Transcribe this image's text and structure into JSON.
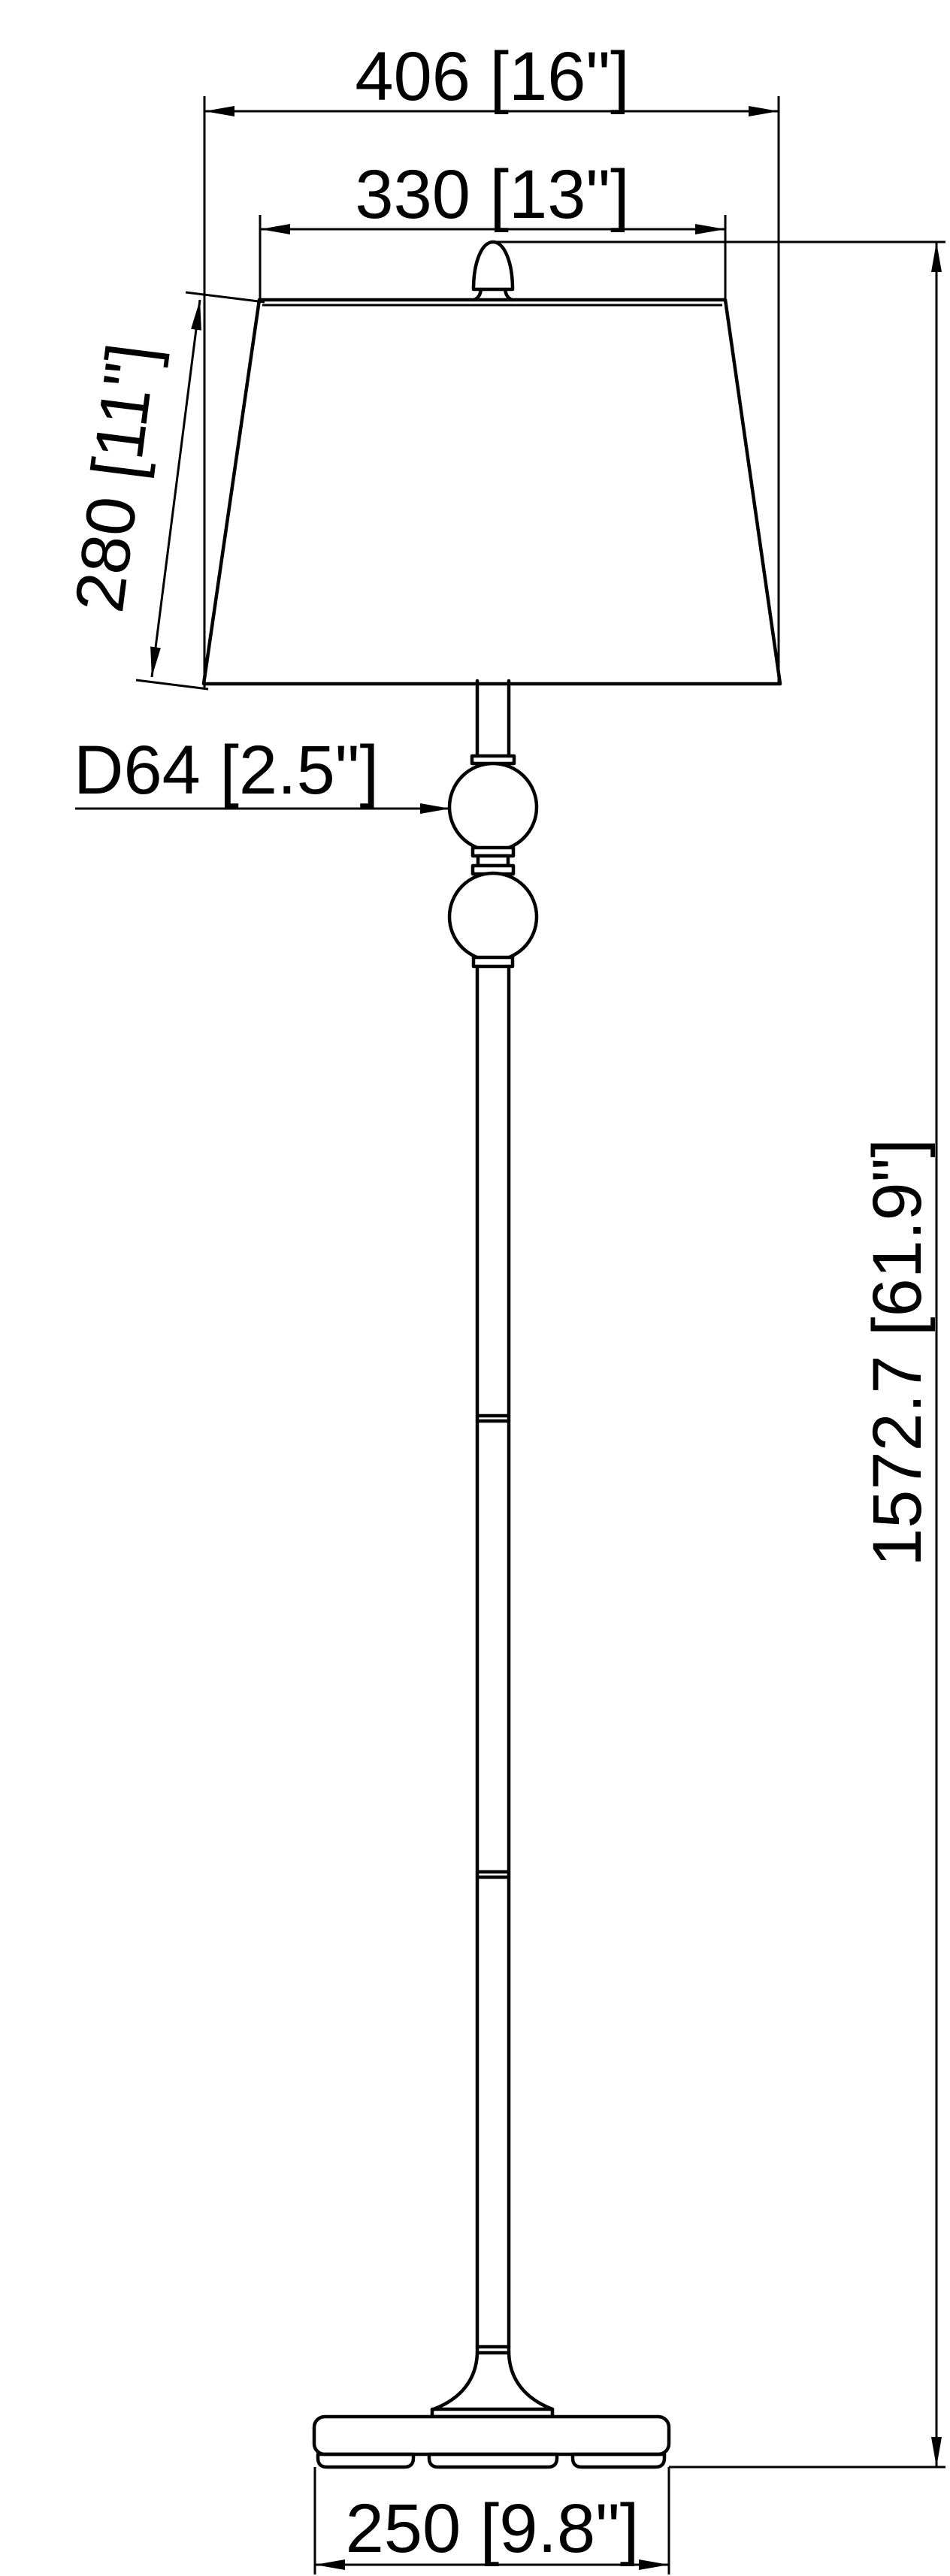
{
  "document": {
    "kind": "technical dimension drawing",
    "subject": "floor lamp with tapered shade, twin glass balls, slim column and oval base",
    "background_color": "#ffffff",
    "line_color": "#000000"
  },
  "dimensions": {
    "shade_bottom_width": {
      "label": "406 [16\"]",
      "value_mm": 406,
      "value_in": "16\"",
      "location": "top, overall shade bottom diameter"
    },
    "shade_top_width": {
      "label": "330 [13\"]",
      "value_mm": 330,
      "value_in": "13\"",
      "location": "top, shade top diameter"
    },
    "shade_height": {
      "label": "280 [11\"]",
      "value_mm": 280,
      "value_in": "11\"",
      "location": "left, slant height of shade"
    },
    "ball_diameter": {
      "label": "D64 [2.5\"]",
      "value_mm": 64,
      "value_in": "2.5\"",
      "location": "left leader pointing to upper glass ball"
    },
    "overall_height": {
      "label": "1572.7 [61.9\"]",
      "value_mm": 1572.7,
      "value_in": "61.9\"",
      "location": "right, finial top to floor"
    },
    "base_width": {
      "label": "250 [9.8\"]",
      "value_mm": 250,
      "value_in": "9.8\"",
      "location": "bottom, base diameter"
    }
  }
}
